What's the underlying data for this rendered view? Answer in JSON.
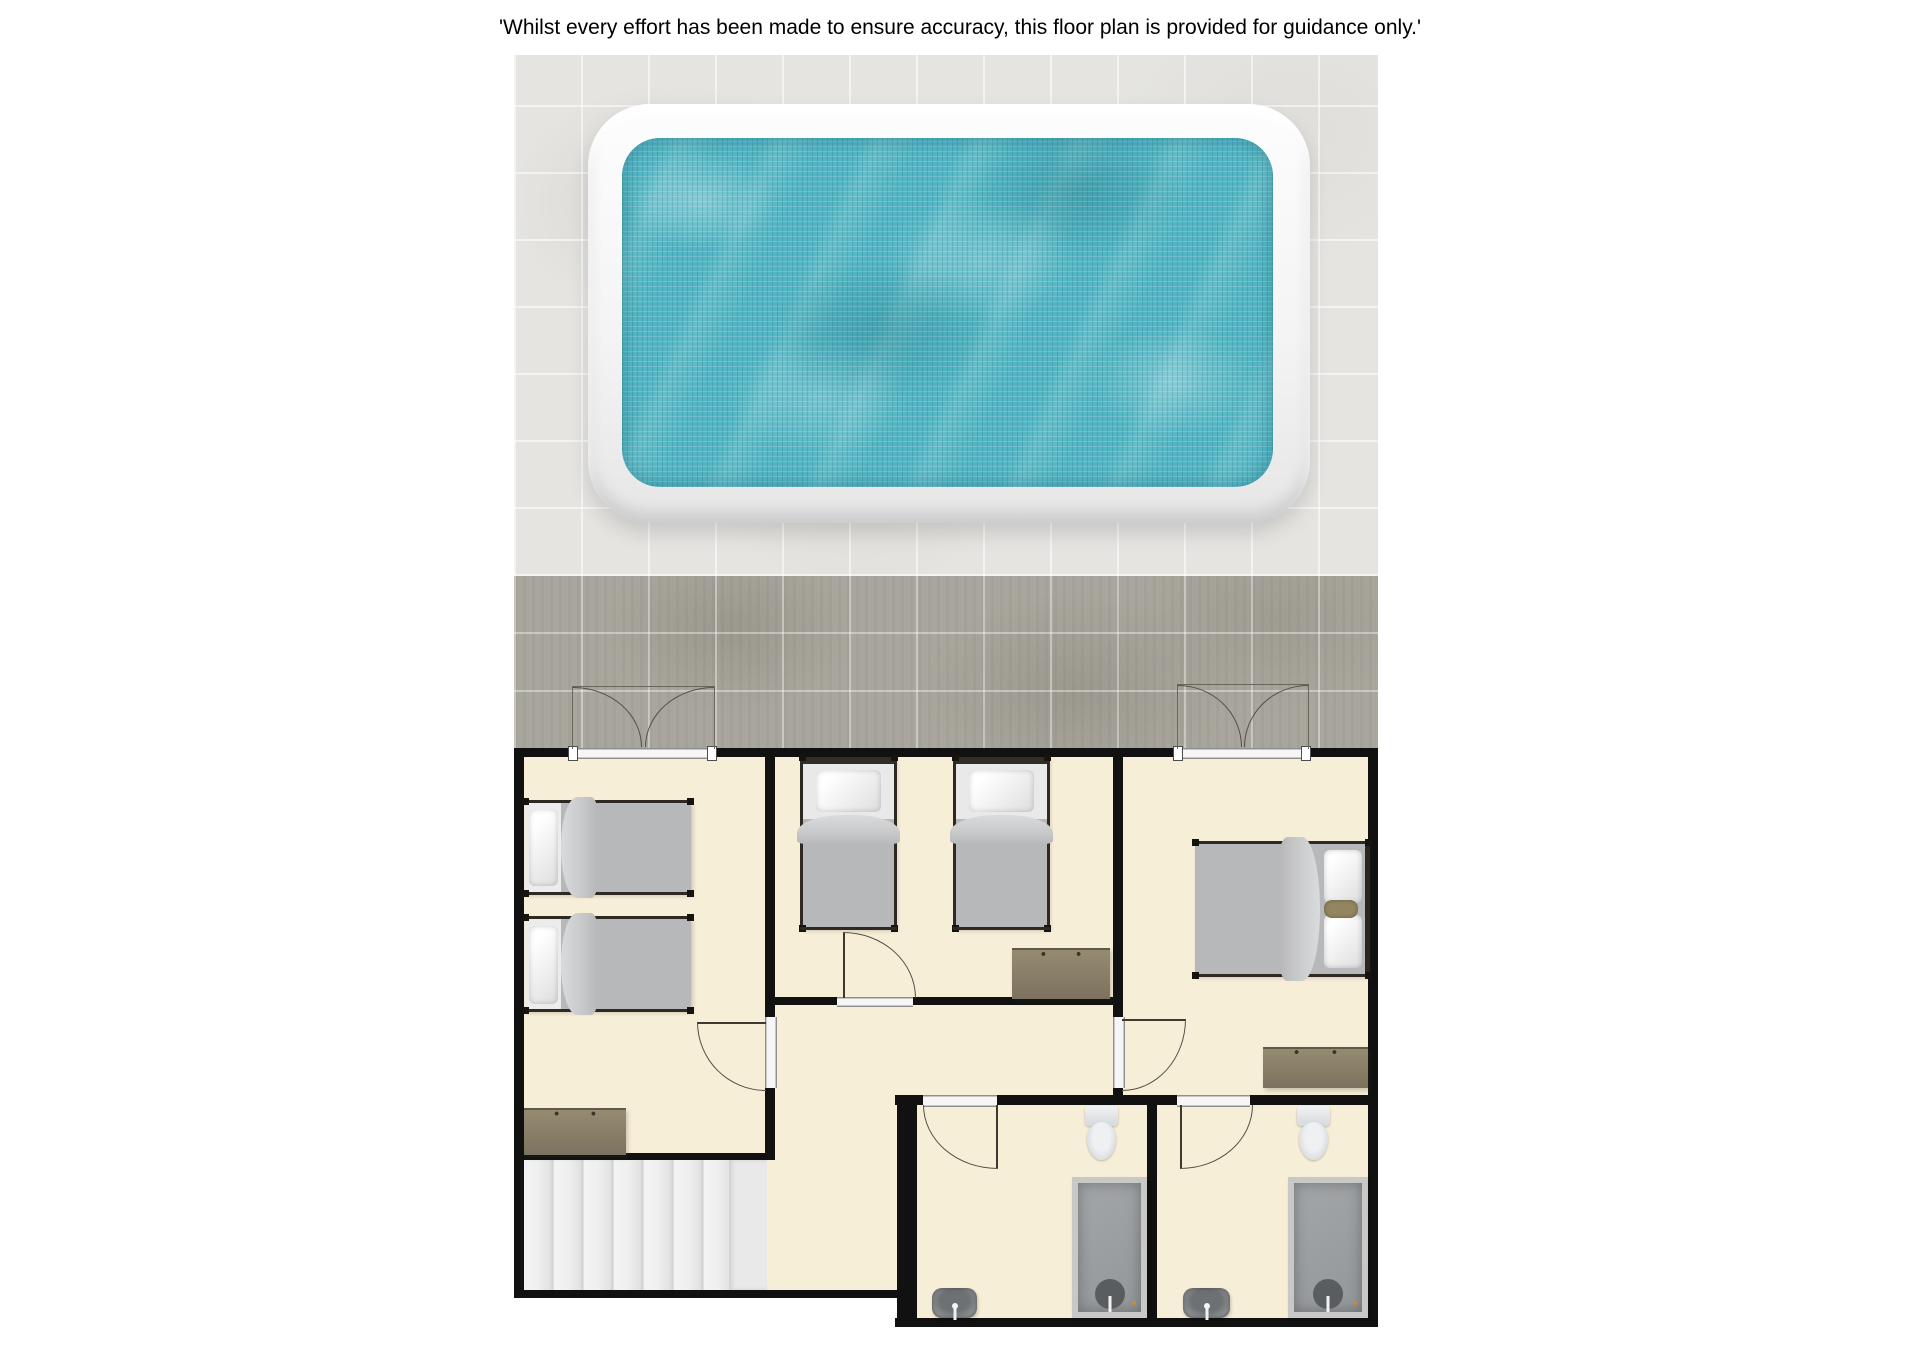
{
  "disclaimer": "'Whilst every effort has been made to ensure accuracy, this floor plan is provided for guidance only.'",
  "palette": {
    "background": "#ffffff",
    "wall": "#111111",
    "room_floor": "#f7eed8",
    "terrace_tile_light": "#e5e4e1",
    "terrace_tile_dark": "#a9a69d",
    "pool_water": "#54b6c4",
    "pool_surround": "#f4f4f4",
    "bed_blanket": "#b7b8ba",
    "bed_frame": "#2e2922",
    "dresser_wood": "#887e66",
    "shower_tray": "#9a9da0",
    "bathroom_fixture": "#e3e6e9",
    "stair_tread": "#ededed",
    "door_line": "#55504a"
  },
  "areas": {
    "terrace": {
      "features": [
        "swimming-pool",
        "pool-surround",
        "tiled-deck"
      ]
    },
    "rooms": [
      {
        "id": "bedroom-left",
        "furniture": [
          "twin-bed",
          "twin-bed",
          "dresser"
        ],
        "doors": [
          "french-doors-to-terrace",
          "door-to-hallway"
        ]
      },
      {
        "id": "bedroom-middle",
        "furniture": [
          "twin-bed",
          "twin-bed",
          "dresser"
        ],
        "doors": [
          "door-to-hallway"
        ]
      },
      {
        "id": "bedroom-right",
        "furniture": [
          "double-bed",
          "dresser"
        ],
        "doors": [
          "french-doors-to-terrace",
          "door-to-hallway",
          "door-to-bathroom-2"
        ]
      },
      {
        "id": "hallway",
        "furniture": [],
        "doors": []
      },
      {
        "id": "staircase",
        "furniture": [
          "stairs"
        ],
        "doors": []
      },
      {
        "id": "bathroom-1",
        "furniture": [
          "toilet",
          "shower",
          "sink"
        ],
        "doors": [
          "door-to-hallway"
        ]
      },
      {
        "id": "bathroom-2",
        "furniture": [
          "toilet",
          "shower",
          "sink"
        ],
        "doors": [
          "door-to-bedroom-right"
        ]
      }
    ]
  }
}
